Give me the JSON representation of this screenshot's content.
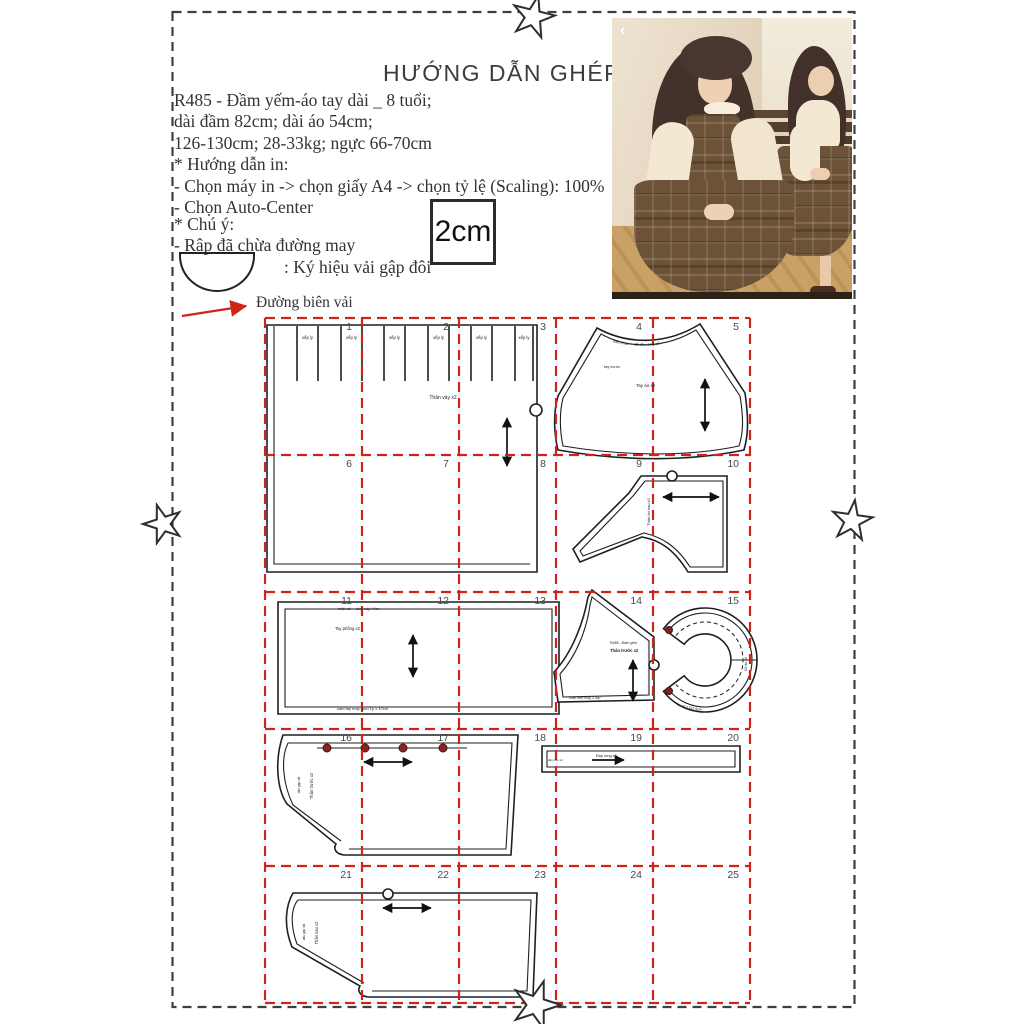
{
  "title": "HƯỚNG DẪN GHÉP RẬP",
  "info": {
    "line1": "R485 - Đầm yếm-áo tay dài _ 8 tuổi;",
    "line2": "dài đầm 82cm; dài áo 54cm;",
    "line3": "126-130cm; 28-33kg; ngực 66-70cm",
    "print_header": "* Hướng dẫn in:",
    "print_step1": "- Chọn máy in -> chọn giấy A4  -> chọn tỷ lệ (Scaling): 100%",
    "print_step2": "- Chọn Auto-Center",
    "note_header": "* Chú ý:",
    "note1": "- Rập đã chừa đường may",
    "fold_symbol_label": ": Ký hiệu vải gập đôi",
    "selvage_label": "Đường biên vải"
  },
  "scale_box": {
    "label": "2cm"
  },
  "photo": {
    "back_chevron": "‹"
  },
  "grid": {
    "numbers": [
      1,
      2,
      3,
      4,
      5,
      6,
      7,
      8,
      9,
      10,
      11,
      12,
      13,
      14,
      15,
      16,
      17,
      18,
      19,
      20,
      21,
      22,
      23,
      24,
      25
    ],
    "line_color": "#cf2418",
    "border_color": "#3f3f3f"
  },
  "pieces": {
    "skirt": {
      "pleat_label": "xếp ly",
      "label": "Thân váy x2"
    },
    "sleeve": {
      "cap_note": "dấu chun + nối đo vòng cổ",
      "front_note": "tay trước",
      "label": "Tay áo x2"
    },
    "back_bodice": {
      "label": "Thân áo sau x2"
    },
    "cuff_panel": {
      "top_note": "mặt vải + cầm xếp Viền",
      "label": "Tay phồng x2",
      "bottom_note": "cầm tay may thun 1p x 47cm"
    },
    "bib": {
      "code_note": "R485 - Đầm yếm",
      "label": "Thân trước x2",
      "bottom_note": "Thân trên may 2 lớp"
    },
    "collar": {
      "side_note": "Cổ áo x2",
      "bottom_note": "bo cổ 0.5x1.5cm"
    },
    "front_panel": {
      "side_note": "dấu gập vải",
      "label": "Thân trước x2"
    },
    "strap_band": {
      "left_note": "dây treo x2",
      "label": "Đáp lưng x2"
    },
    "back_panel": {
      "side_note": "dấu gập vải",
      "label": "Thân sau x2"
    }
  }
}
